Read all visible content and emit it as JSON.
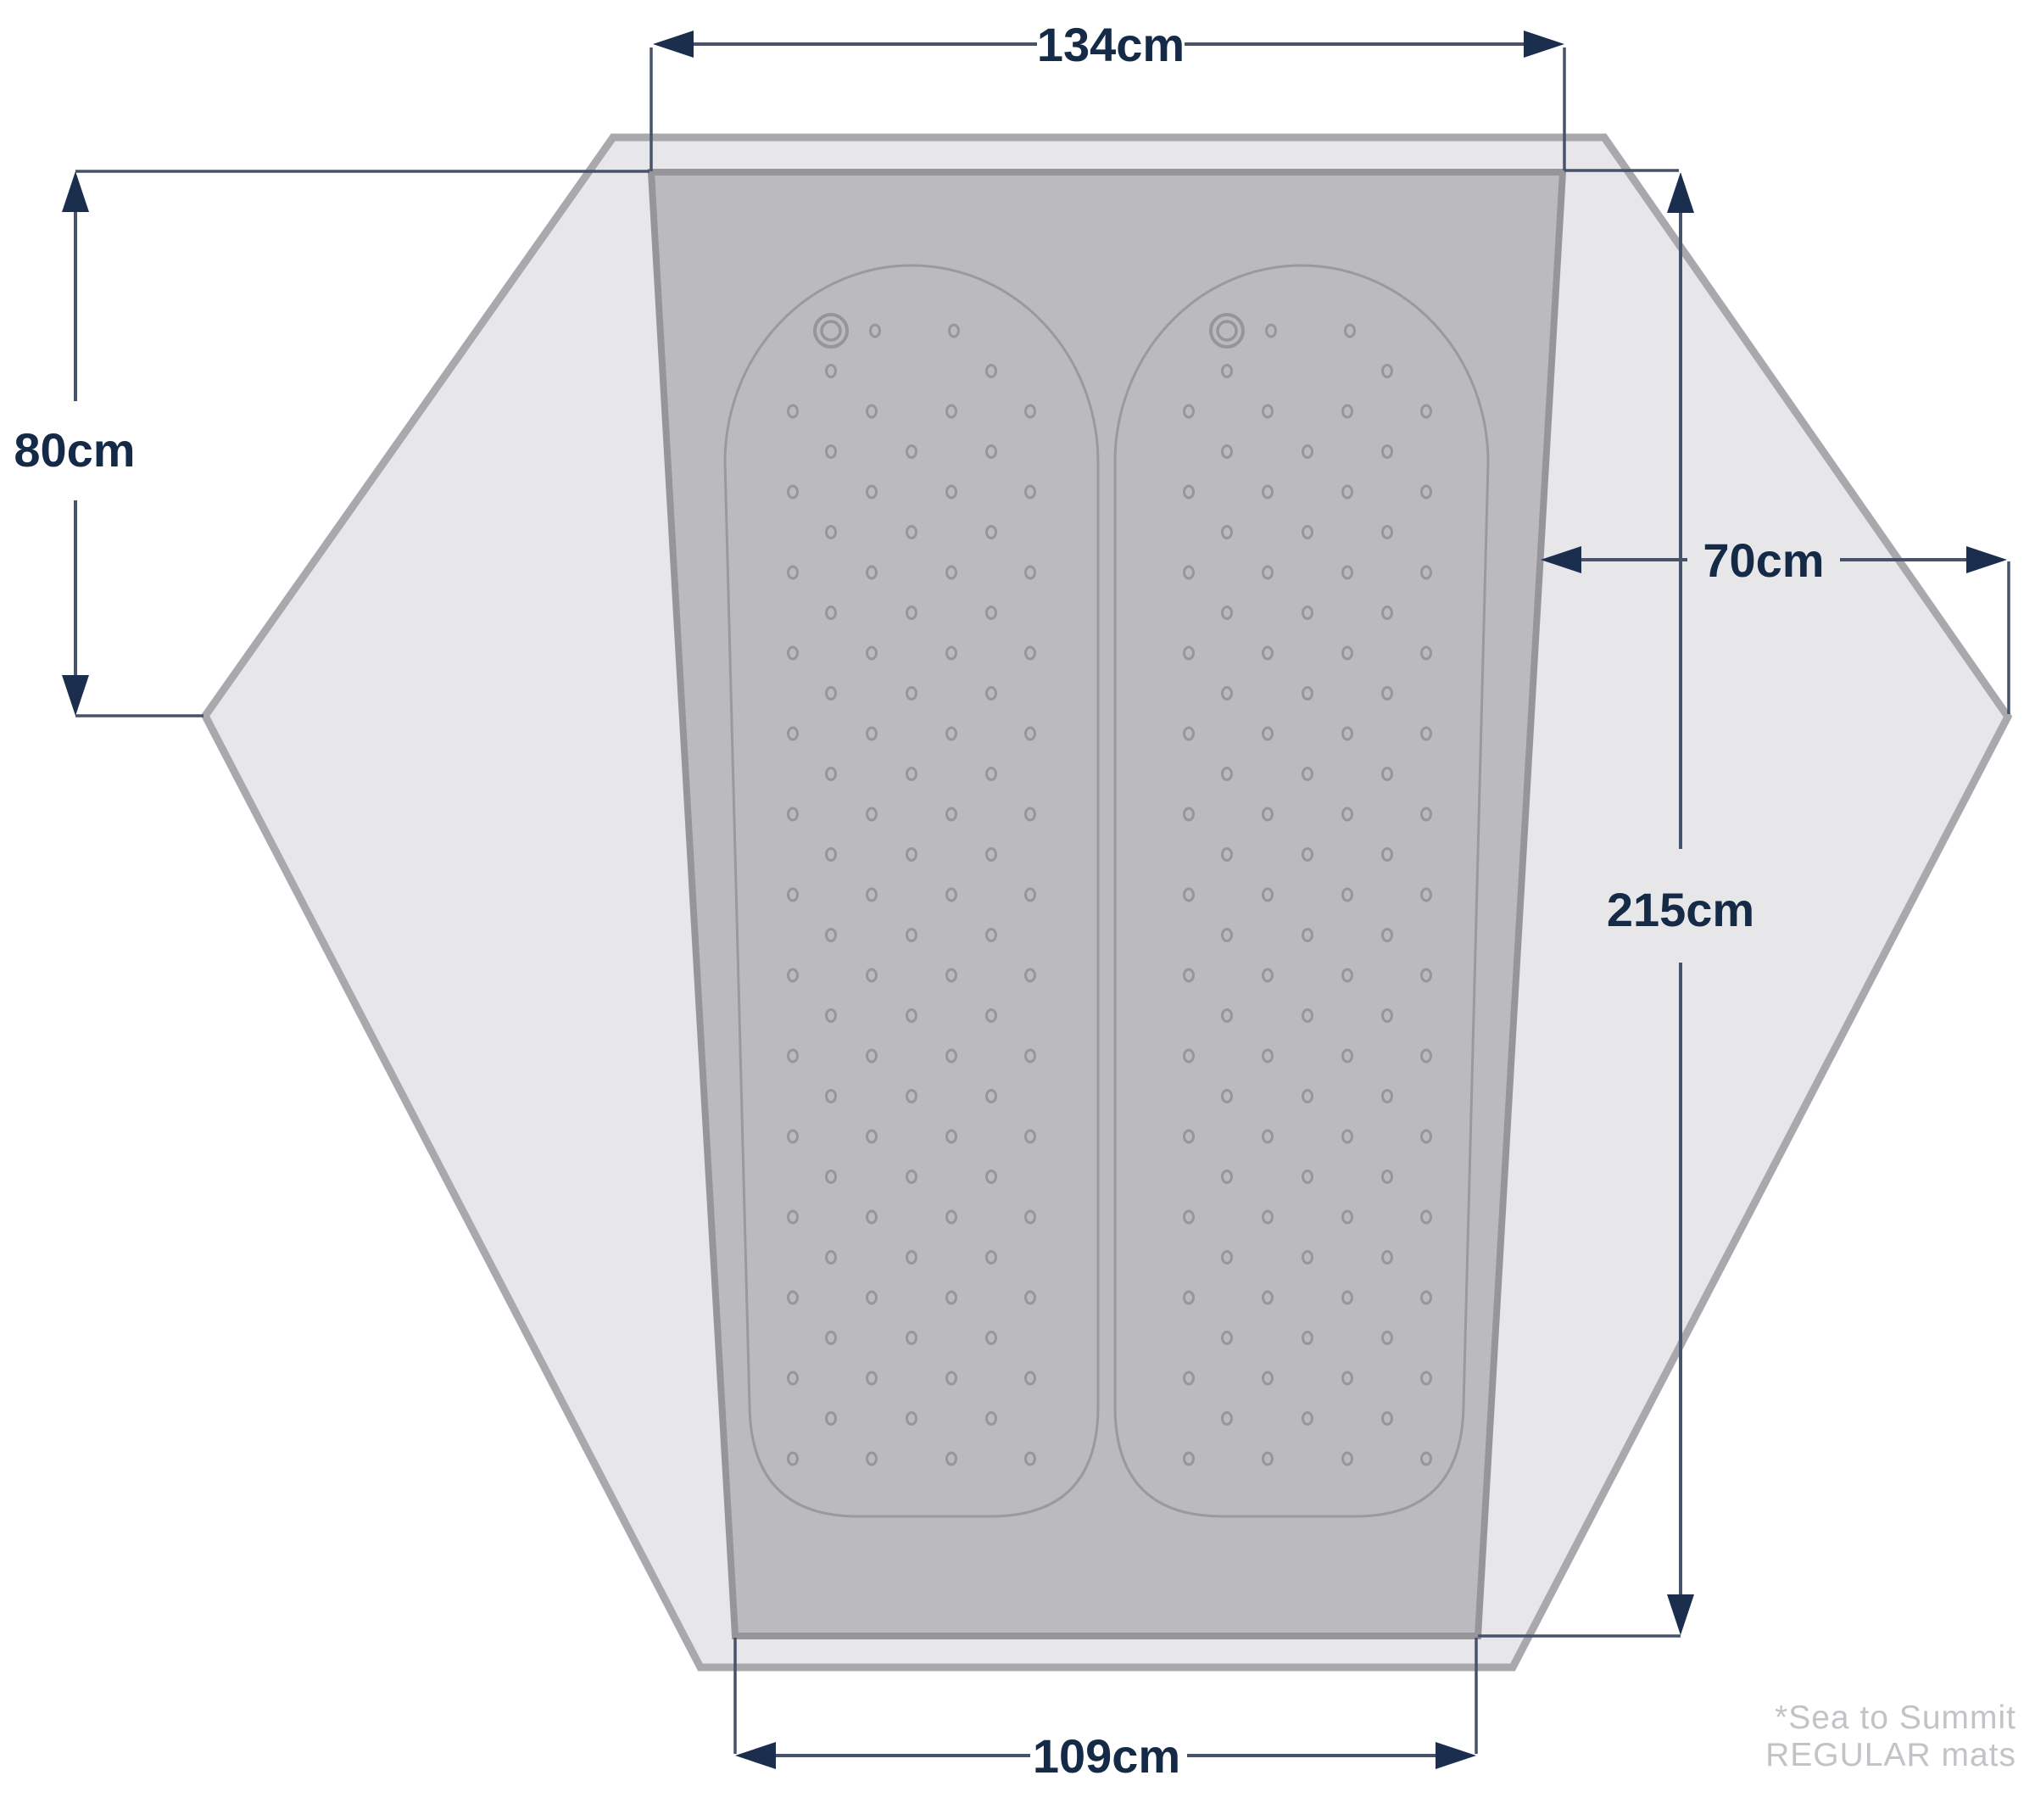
{
  "diagram": {
    "type": "tent-floorplan-dimensions",
    "dimensions": {
      "top_width": "134cm",
      "left_vestibule_depth": "80cm",
      "right_vestibule_width": "70cm",
      "floor_length": "215cm",
      "bottom_width": "109cm"
    },
    "footnote": {
      "line1": "*Sea to Summit",
      "line2": "REGULAR mats"
    },
    "colors": {
      "background": "#ffffff",
      "fly_fill": "#e7e7e9",
      "fly_stroke": "#a9a9ad",
      "floor_fill": "#bbbbbf",
      "floor_stroke": "#96969a",
      "mat_stroke": "#9a9a9e",
      "dimension_line": "#47536b",
      "arrowhead": "#1b2e4e",
      "label_text": "#152a47",
      "footnote_text": "#c3c3c7"
    }
  }
}
